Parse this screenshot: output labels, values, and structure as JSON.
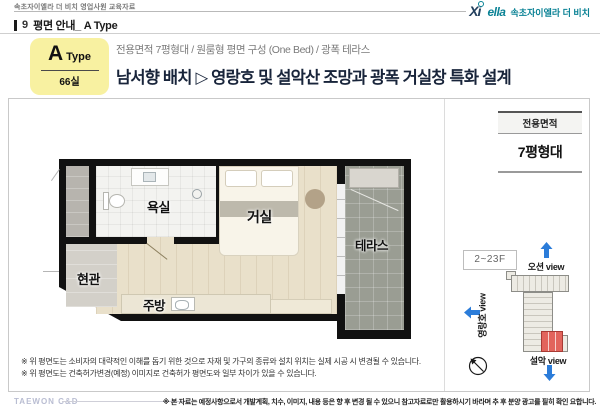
{
  "meta": {
    "doc_label": "속초자이엘라 더 비치 영업사원 교육자료",
    "page_no": "9",
    "page_title": "평면 안내_ A Type"
  },
  "brand": {
    "xi": "Xi",
    "ella": "ella",
    "kr": "속초자이엘라 더 비치"
  },
  "type_box": {
    "letter": "A",
    "word": "Type",
    "units": "66실"
  },
  "headline": {
    "sub": "전용면적 7평형대 / 원룸형 평면 구성 (One Bed) / 광폭 테라스",
    "main": "남서향 배치 ▷ 영랑호 및 설악산 조망과 광폭 거실창 특화 설계"
  },
  "area_table": {
    "header": "전용면적",
    "value": "7평형대"
  },
  "floor_plan": {
    "rooms": {
      "bath": "욕실",
      "living": "거실",
      "terrace": "테라스",
      "entry": "현관",
      "kitchen": "주방"
    }
  },
  "site_diagram": {
    "floors": "2~23F",
    "view_top": "오션 view",
    "view_left": "영랑호 view",
    "view_bottom": "설악 view"
  },
  "notes": [
    "※ 위 평면도는 소비자의 대략적인 이해를 돕기 위한 것으로 자재 및 가구의 종류와 설치 위치는 실제 시공 시 변경될 수 있습니다.",
    "※ 위 평면도는 건축허가변경(예정) 이미지로 건축허가 평면도와 일부 차이가 있을 수 있습니다."
  ],
  "footer": {
    "logo": "TAEWON C&D",
    "disclaimer": "※ 본 자료는 예정사항으로서 개발계획, 치수, 이미지, 내용 등은 향 후 변경 될 수 있으니 참고자료로만 활용하시기 바라며 추 후 분양 광고를 필히 확인 요합니다."
  },
  "colors": {
    "accent_yellow": "#f8f1a1",
    "headline_navy": "#18243a",
    "arrow_blue": "#2b7cd9",
    "unit_red": "#e2645c",
    "brand_teal": "#0a8295"
  }
}
